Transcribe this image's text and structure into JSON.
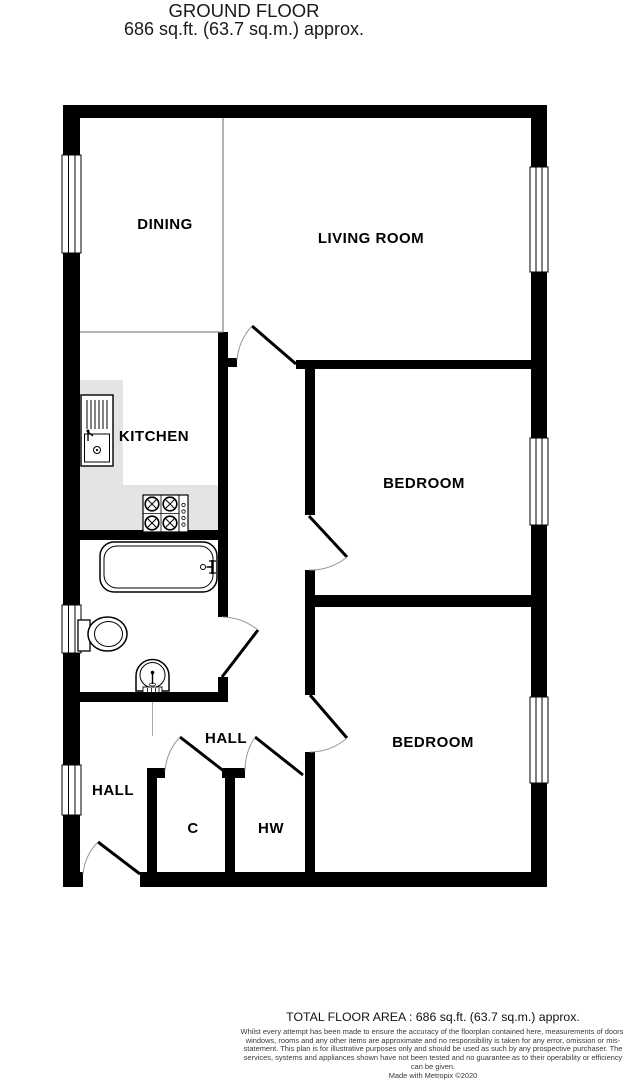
{
  "header": {
    "title": "GROUND FLOOR",
    "subtitle": "686 sq.ft. (63.7 sq.m.) approx."
  },
  "plan": {
    "rooms": [
      {
        "id": "dining",
        "label": "DINING"
      },
      {
        "id": "living-room",
        "label": "LIVING ROOM"
      },
      {
        "id": "kitchen",
        "label": "KITCHEN"
      },
      {
        "id": "bedroom-1",
        "label": "BEDROOM"
      },
      {
        "id": "bedroom-2",
        "label": "BEDROOM"
      },
      {
        "id": "hall-left",
        "label": "HALL"
      },
      {
        "id": "hall-middle",
        "label": "HALL"
      },
      {
        "id": "closet",
        "label": "C"
      },
      {
        "id": "hot-water-cupboard",
        "label": "HW"
      }
    ],
    "fixtures": [
      "kitchen-sink-unit",
      "hob",
      "bathtub",
      "toilet",
      "pedestal-basin"
    ],
    "window_count": 6,
    "door_count": 7
  },
  "footer": {
    "total_area": "TOTAL FLOOR AREA : 686 sq.ft. (63.7 sq.m.) approx.",
    "disclaimer": "Whilst every attempt has been made to ensure the accuracy of the floorplan contained here, measurements of doors, windows, rooms and any other items are approximate and no responsibility is taken for any error, omission or mis-statement. This plan is for illustrative purposes only and should be used as such by any prospective purchaser. The services, systems and appliances shown have not been tested and no guarantee as to their operability or efficiency can be given.",
    "credit": "Made with Metropix ©2020"
  },
  "colors": {
    "wall": "#000000",
    "counter": "#e4e4e4",
    "thin_partition": "#8a8a8a",
    "door_arc": "#999999",
    "background": "#ffffff"
  }
}
